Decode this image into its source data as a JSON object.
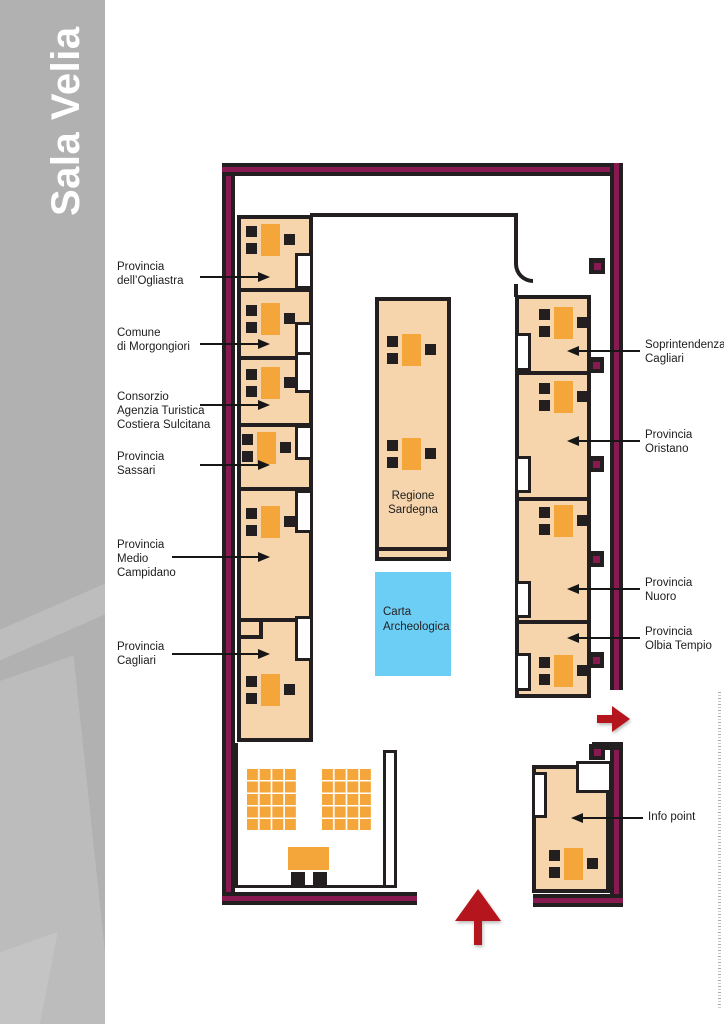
{
  "sidebar": {
    "title": "Sala Velia"
  },
  "plan": {
    "center_booth_label": "Regione\nSardegna",
    "carta_label": "Carta\nArcheologica",
    "callouts_left": [
      {
        "label": "Provincia\ndell’Ogliastra"
      },
      {
        "label": "Comune\ndi Morgongiori"
      },
      {
        "label": "Consorzio\nAgenzia Turistica\nCostiera Sulcitana"
      },
      {
        "label": "Provincia\nSassari"
      },
      {
        "label": "Provincia\nMedio\nCampidano"
      },
      {
        "label": "Provincia\nCagliari"
      }
    ],
    "callouts_right": [
      {
        "label": "Soprintendenza\nCagliari"
      },
      {
        "label": "Provincia\nOristano"
      },
      {
        "label": "Provincia\nNuoro"
      },
      {
        "label": "Provincia\nOlbia Tempio"
      },
      {
        "label": "Info point"
      }
    ],
    "arrows": {
      "entrance": "up",
      "exit": "right"
    },
    "seating": {
      "chair_rows": 3,
      "chairs_per_row": 6,
      "speaker_table": true
    },
    "colors": {
      "sidebar_gray": "#b1b1b1",
      "wall_black": "#231f20",
      "wall_magenta": "#891a51",
      "booth_fill": "#f6d5ac",
      "furniture_orange": "#f5a63a",
      "carta_blue": "#6dcef5",
      "arrow_red": "#b5161d"
    }
  }
}
